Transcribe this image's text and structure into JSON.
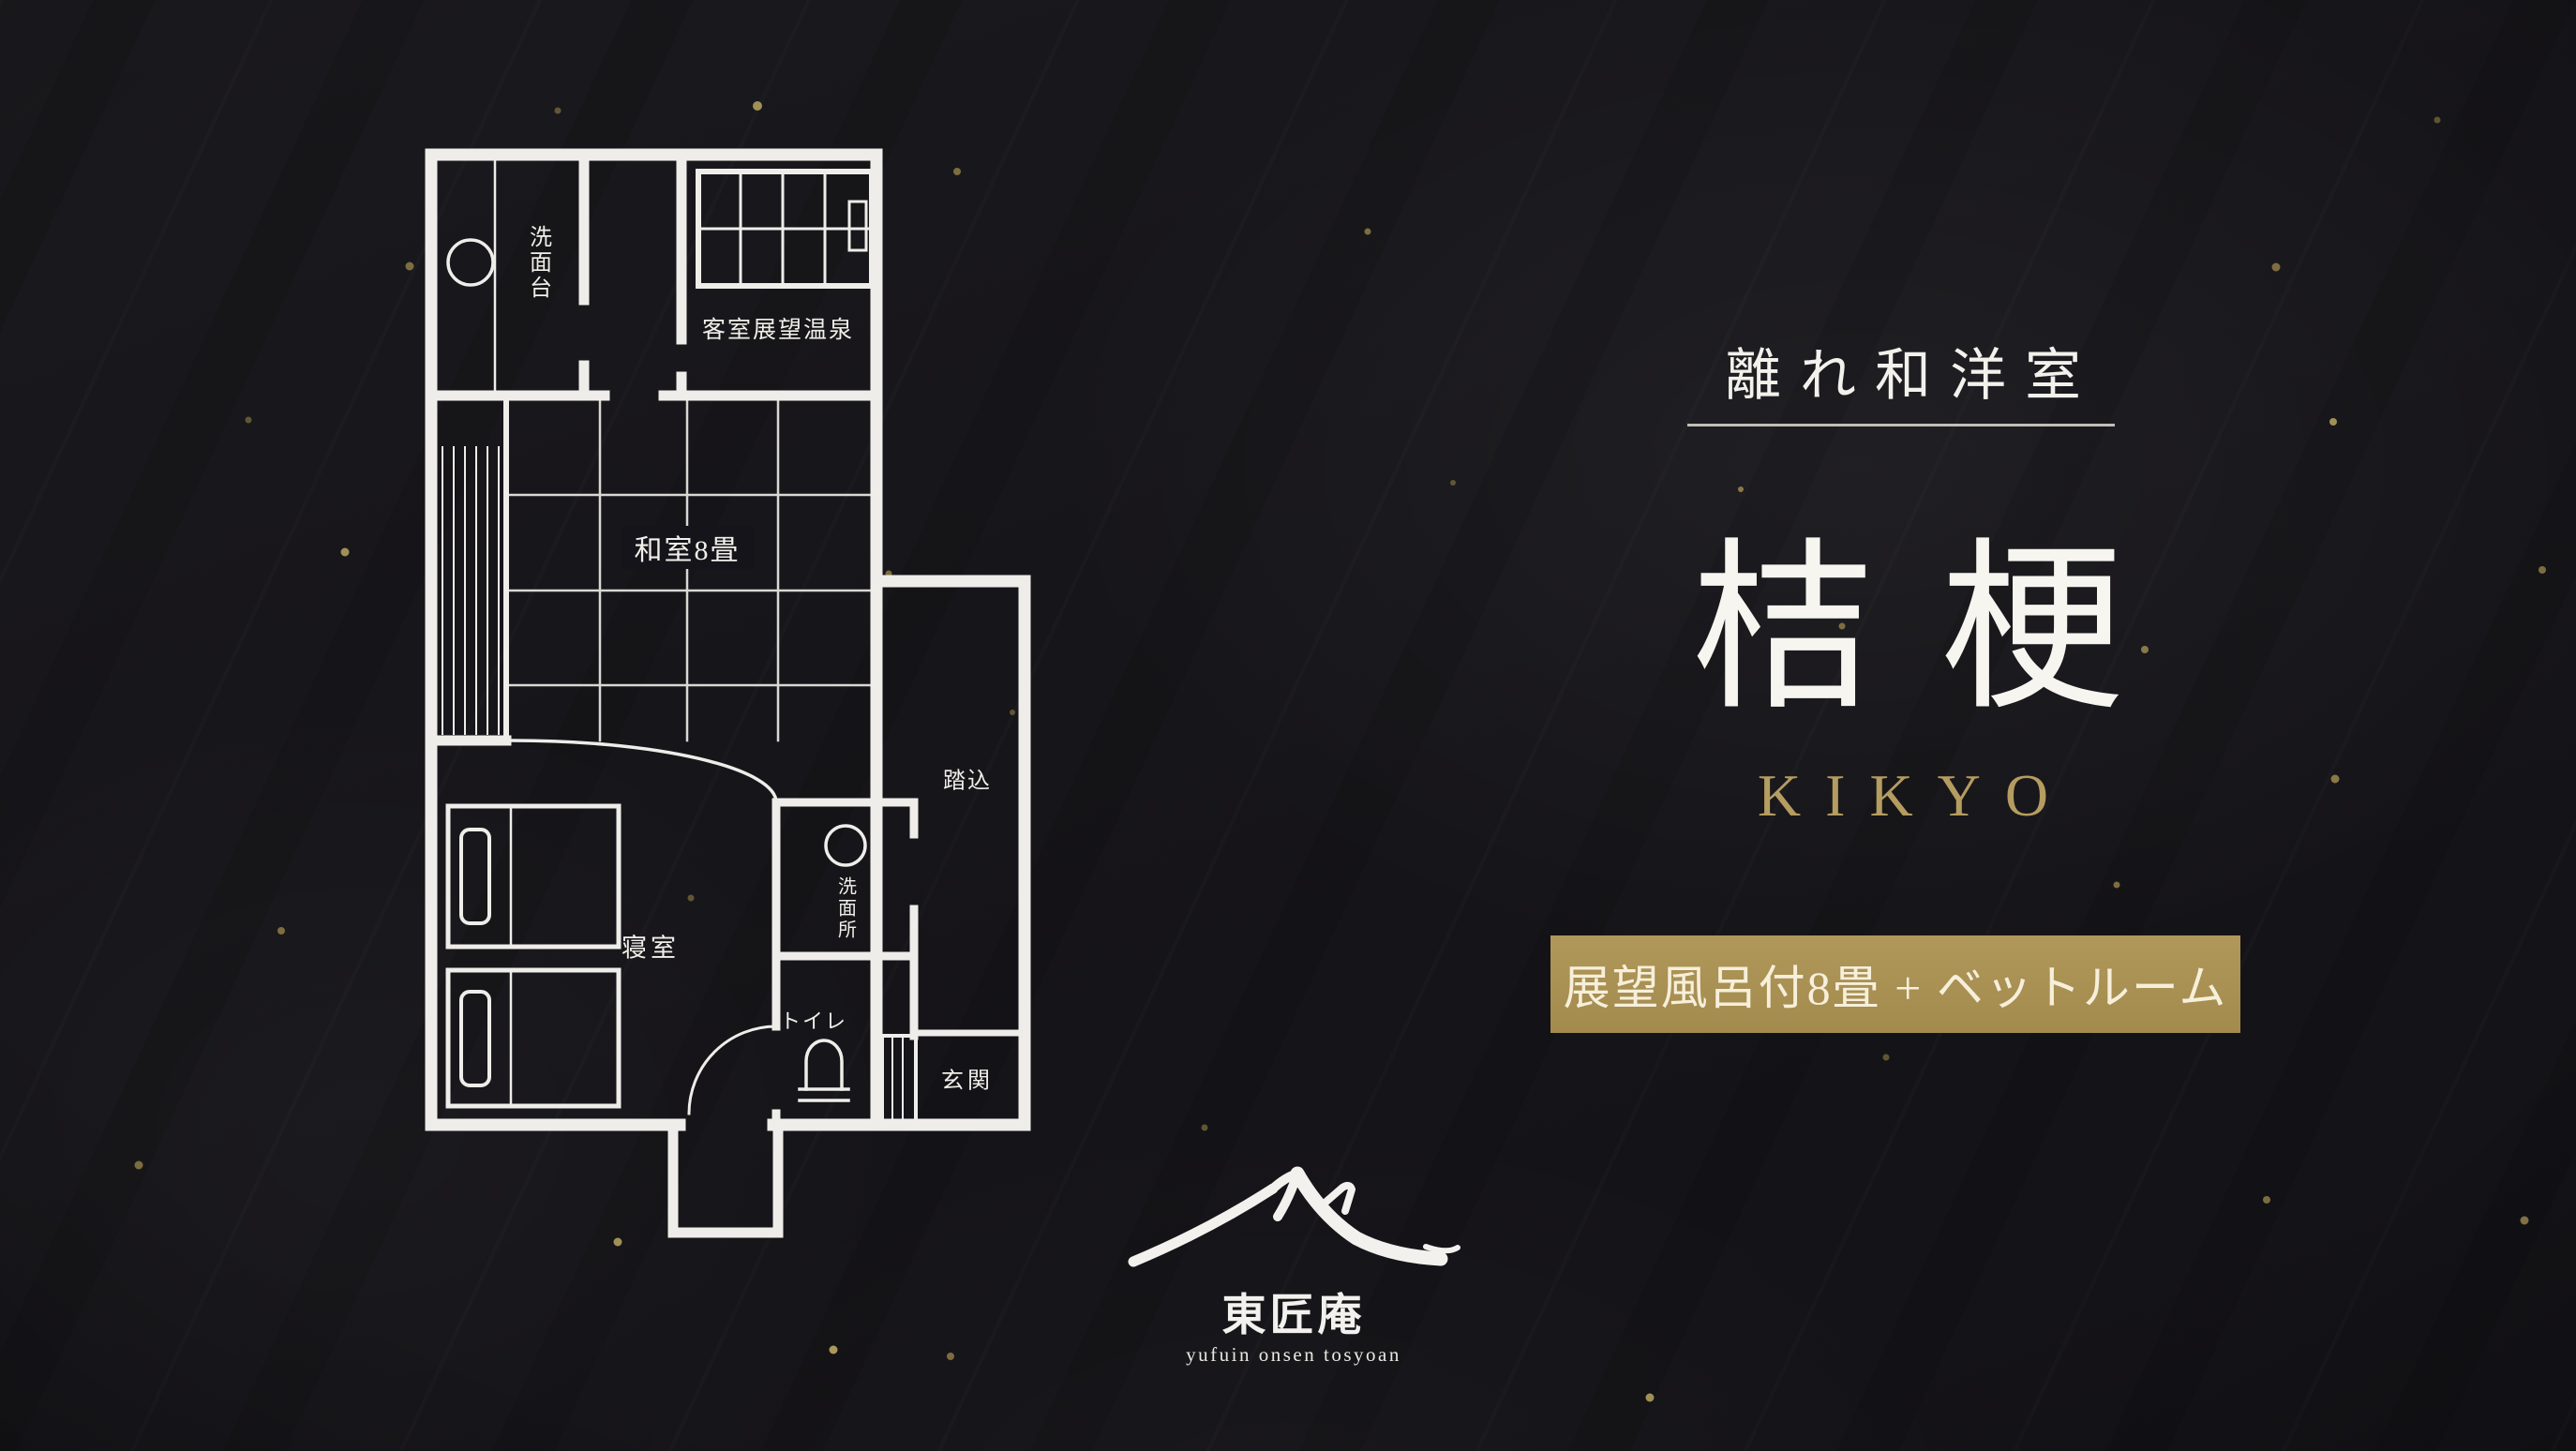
{
  "header": {
    "category": "離れ和洋室",
    "room_name": "桔梗",
    "room_name_romaji": "KIKYO",
    "amenity_badge": "展望風呂付8畳 + ベットルーム"
  },
  "floor_plan": {
    "labels": {
      "washstand": "洗面台",
      "guest_room_view_bath": "客室展望温泉",
      "japanese_room_8_tatami": "和室8畳",
      "bedroom": "寝室",
      "washroom": "洗面所",
      "toilet": "トイレ",
      "entry_step": "踏込",
      "entrance": "玄関"
    }
  },
  "logo": {
    "brand_kanji": "東匠庵",
    "brand_romaji": "yufuin onsen tosyoan"
  },
  "colors": {
    "background": "#161519",
    "plan_line": "#eeede9",
    "title_text": "#f4f2ec",
    "gold_accent": "#b59c60",
    "badge_background": "#a98f52",
    "badge_text": "#f6efda",
    "speck_gold": "#c5b06b"
  }
}
